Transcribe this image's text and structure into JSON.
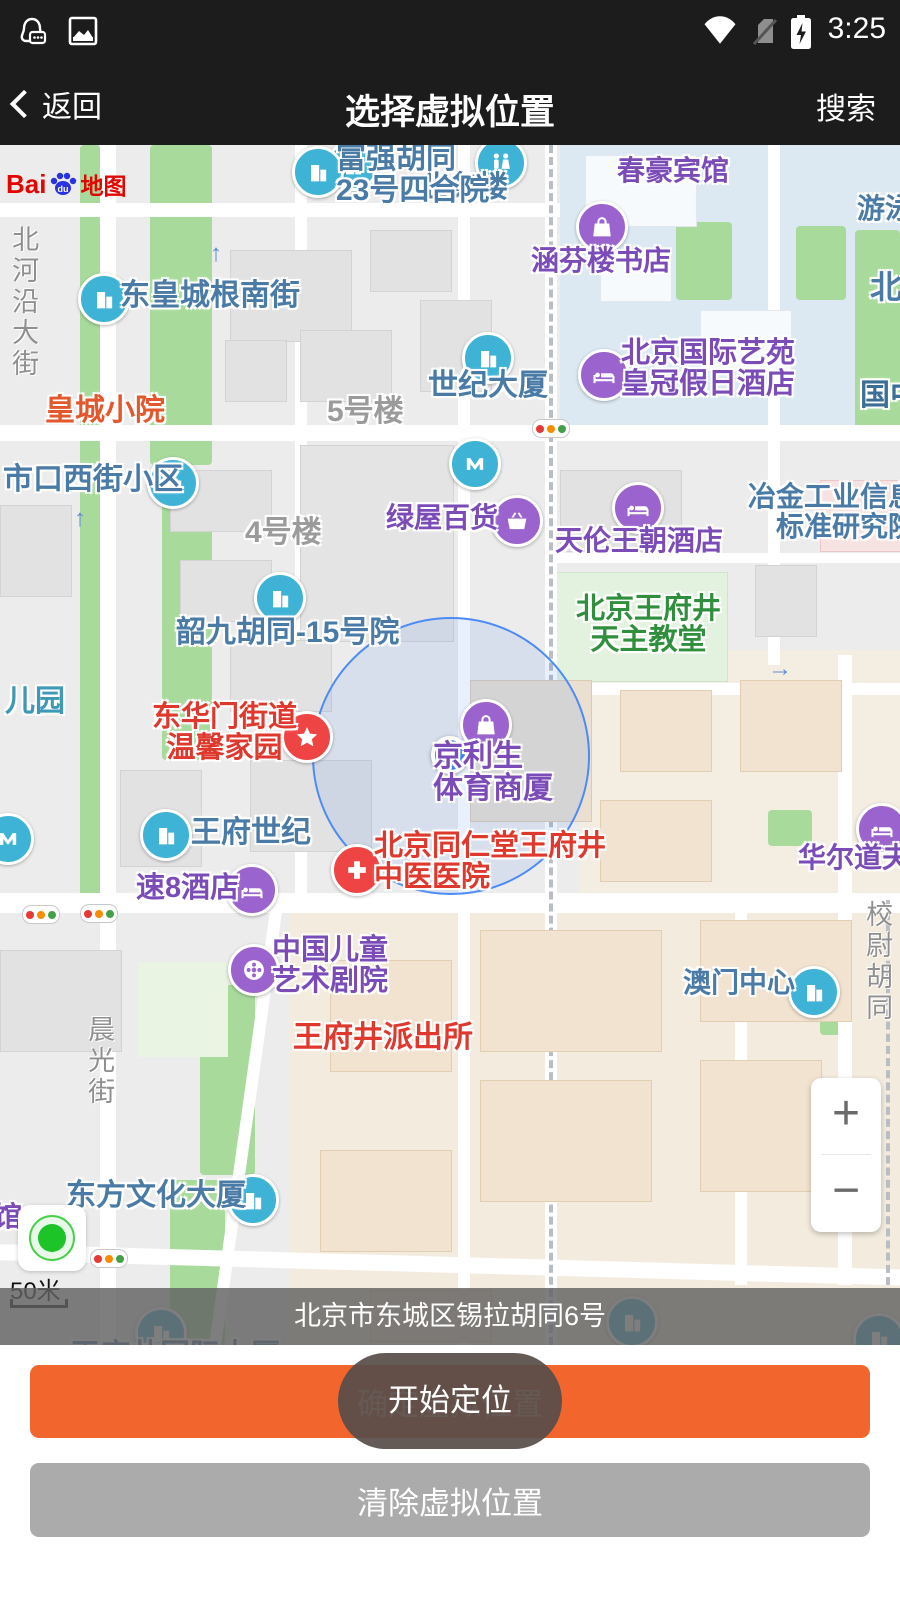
{
  "status_bar": {
    "time": "3:25",
    "icons": [
      "qq-chat-icon",
      "screenshot-icon",
      "wifi-icon",
      "no-sim-icon",
      "battery-charging-icon"
    ]
  },
  "nav_bar": {
    "back": "返回",
    "title": "选择虚拟位置",
    "search": "搜索"
  },
  "map": {
    "logo": {
      "bai": "Bai",
      "du": "du",
      "suffix": "地图"
    },
    "scale": "50米",
    "zoom_in": "+",
    "zoom_out": "−",
    "pois": [
      {
        "lines": [
          "业务楼"
        ],
        "color": "blue",
        "icon": "building"
      },
      {
        "lines": [
          "富强胡同",
          "23号四合院"
        ],
        "color": "blue",
        "icon": "building"
      },
      {
        "lines": [
          "春豪宾馆"
        ],
        "color": "purple",
        "icon": null
      },
      {
        "lines": [
          "涵芬楼书店"
        ],
        "color": "purple",
        "icon": "shopping-bag"
      },
      {
        "lines": [
          "游泳"
        ],
        "color": "blue",
        "icon": null
      },
      {
        "lines": [
          "世纪大厦"
        ],
        "color": "blue",
        "icon": "building"
      },
      {
        "lines": [
          "北京国际艺苑",
          "皇冠假日酒店"
        ],
        "color": "purple",
        "icon": "hotel-bed"
      },
      {
        "lines": [
          "国中"
        ],
        "color": "dkblue",
        "icon": null
      },
      {
        "lines": [
          "北"
        ],
        "color": "blue",
        "icon": null
      },
      {
        "lines": [
          "皇城小院"
        ],
        "color": "orange",
        "icon": null
      },
      {
        "lines": [
          "5号楼"
        ],
        "color": "gray",
        "icon": null
      },
      {
        "lines": [
          "北河沿大街"
        ],
        "color": "street",
        "icon": null
      },
      {
        "lines": [
          "东皇城根南街"
        ],
        "color": "blue",
        "icon": "building"
      },
      {
        "lines": [
          "市口西街小区"
        ],
        "color": "blue",
        "icon": "building"
      },
      {
        "lines": [
          "绿屋百货"
        ],
        "color": "purple",
        "icon": "basket"
      },
      {
        "lines": [
          "天伦王朝酒店"
        ],
        "color": "purple",
        "icon": "hotel-bed"
      },
      {
        "lines": [
          "冶金工业信息",
          "标准研究院"
        ],
        "color": "blue",
        "icon": null
      },
      {
        "lines": [
          "韶九胡同-15号院"
        ],
        "color": "blue",
        "icon": "building"
      },
      {
        "lines": [
          "北京王府井",
          "天主教堂"
        ],
        "color": "green",
        "icon": null
      },
      {
        "lines": [
          "儿园"
        ],
        "color": "teal",
        "icon": null
      },
      {
        "lines": [
          "东华门街道",
          "温馨家园"
        ],
        "color": "red",
        "icon": "star"
      },
      {
        "lines": [
          "京利生",
          "体育商厦"
        ],
        "color": "purple",
        "icon": "shopping-bag"
      },
      {
        "lines": [
          "王府世纪"
        ],
        "color": "blue",
        "icon": "building"
      },
      {
        "lines": [
          "速8酒店"
        ],
        "color": "purple",
        "icon": "hotel-bed"
      },
      {
        "lines": [
          "北京同仁堂王府井",
          "中医医院"
        ],
        "color": "red",
        "icon": "medical-cross"
      },
      {
        "lines": [
          "华尔道夫"
        ],
        "color": "purple",
        "icon": "hotel-bed"
      },
      {
        "lines": [
          "校尉胡同"
        ],
        "color": "street",
        "icon": null
      },
      {
        "lines": [
          "澳门中心"
        ],
        "color": "blue",
        "icon": "building"
      },
      {
        "lines": [
          "中国儿童",
          "艺术剧院"
        ],
        "color": "purple",
        "icon": "film-reel"
      },
      {
        "lines": [
          "王府井派出所"
        ],
        "color": "red",
        "icon": null
      },
      {
        "lines": [
          "晨光街"
        ],
        "color": "street",
        "icon": null
      },
      {
        "lines": [
          "东方文化大厦"
        ],
        "color": "blue",
        "icon": "building"
      },
      {
        "lines": [
          "馆"
        ],
        "color": "purple",
        "icon": null
      },
      {
        "lines": [
          "王府井国际大厦"
        ],
        "color": "blue",
        "icon": "building"
      },
      {
        "lines": [
          "4号楼"
        ],
        "color": "gray",
        "icon": null
      }
    ],
    "marker": {
      "type": "current-location-dot",
      "accuracy_circle": true
    }
  },
  "address_bar": {
    "text": "北京市东城区锡拉胡同6号"
  },
  "footer": {
    "confirm_label": "确定虚拟位置",
    "toast": "开始定位",
    "clear_label": "清除虚拟位置"
  },
  "colors": {
    "accent_orange": "#F2662E",
    "clear_gray": "#ABABAB",
    "toast_bg": "rgba(88,78,73,0.93)",
    "label_blue": "#4A7BA6",
    "label_purple": "#7B4CB8",
    "label_red": "#DF382D",
    "label_green": "#2F8F3C",
    "label_orange": "#E2572B",
    "label_gray": "#9B9B9B",
    "icon_teal": "#3EB3D6",
    "icon_purple": "#9A63CD",
    "icon_red": "#EF4444",
    "accuracy_blue": "#4C8BF5",
    "topbar_black": "#1c1c1c"
  }
}
